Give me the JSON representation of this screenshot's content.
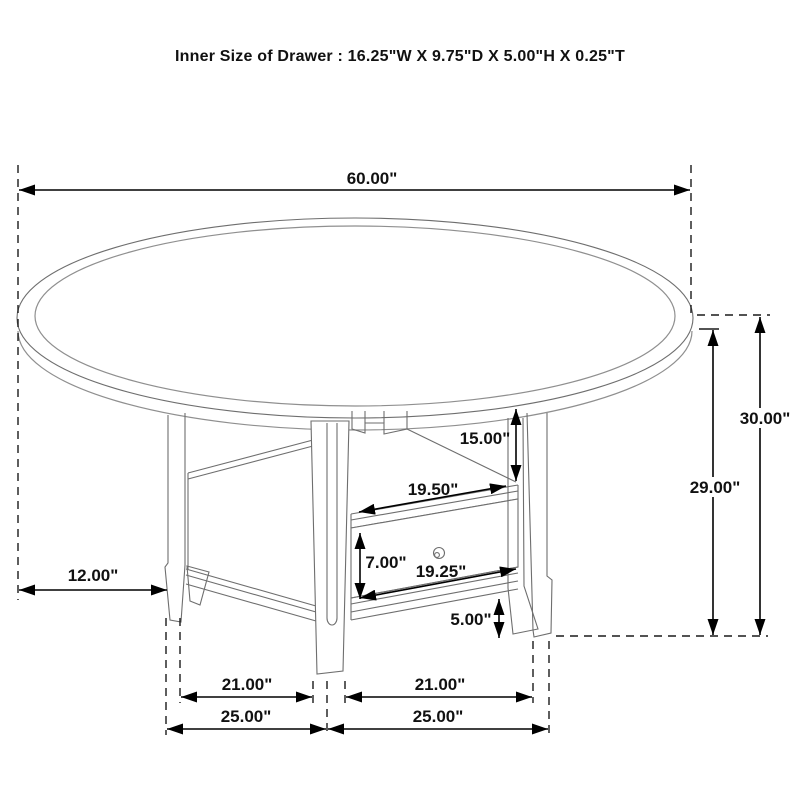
{
  "title": "Inner Size of Drawer : 16.25\"W X 9.75\"D X 5.00\"H X 0.25\"T",
  "dimensions": {
    "tabletop_diameter": "60.00\"",
    "overall_height": "30.00\"",
    "underside_height": "29.00\"",
    "shelf_opening_height": "15.00\"",
    "shelf_opening_width": "19.50\"",
    "drawer_face_height": "7.00\"",
    "drawer_face_width": "19.25\"",
    "bottom_rail_clearance": "5.00\"",
    "tabletop_overhang": "12.00\"",
    "leg_spacing_left": "21.00\"",
    "leg_spacing_right": "21.00\"",
    "base_span_left": "25.00\"",
    "base_span_right": "25.00\""
  }
}
